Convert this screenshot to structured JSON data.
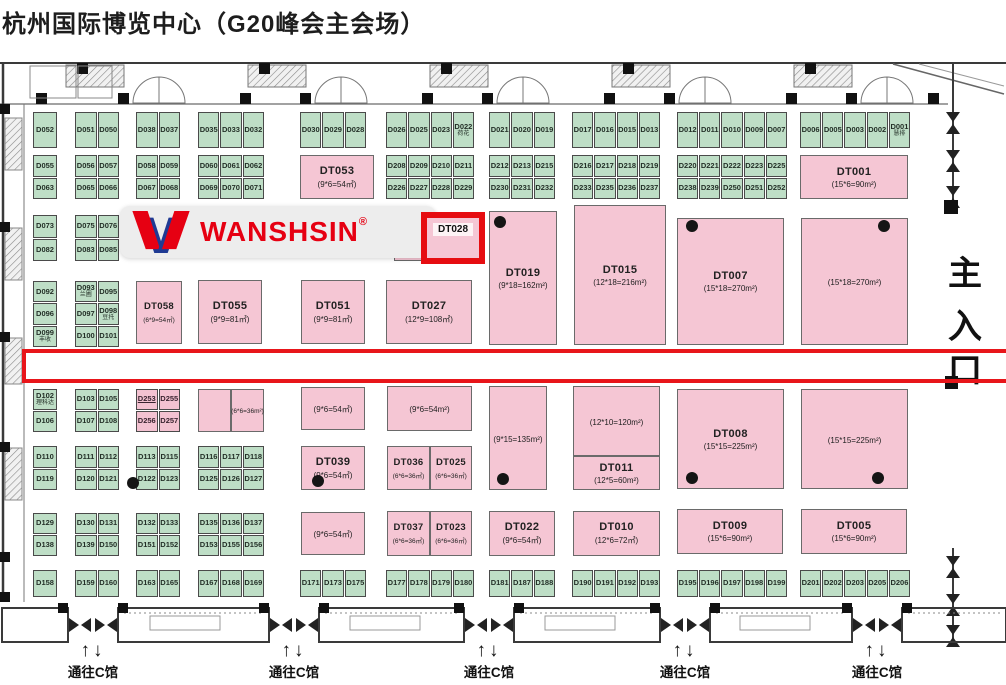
{
  "title": "杭州国际博览中心（G20峰会主会场）",
  "colors": {
    "green_booth": "#bedec6",
    "pink_booth": "#f5c6d4",
    "highlight_red": "#e8151a",
    "logo_red": "#e60012",
    "logo_blue": "#1f3a93"
  },
  "logo": {
    "text": "WANSHSIN",
    "reg": "®"
  },
  "entrance": {
    "chars": [
      "主",
      "入",
      "口"
    ]
  },
  "gates": {
    "label": "通往C馆",
    "arrows": "↑↓",
    "positions": [
      93,
      294,
      489,
      685,
      877
    ]
  },
  "annotations": {
    "highlight": {
      "label": "DT028",
      "x": 421,
      "y": 212,
      "w": 64,
      "h": 52
    },
    "aisle": {
      "x": 22,
      "y": 349,
      "w": 984,
      "h": 34
    },
    "banner": {
      "x": 120,
      "y": 206,
      "w": 292,
      "h": 52
    }
  },
  "floor": {
    "cell_groups": [
      {
        "x": 33,
        "y": 112,
        "w": 24,
        "h": 36,
        "rows": [
          [
            "D052"
          ]
        ]
      },
      {
        "x": 75,
        "y": 112,
        "w": 44,
        "h": 36,
        "rows": [
          [
            "D051",
            "D050"
          ]
        ]
      },
      {
        "x": 136,
        "y": 112,
        "w": 44,
        "h": 36,
        "rows": [
          [
            "D038",
            "D037"
          ]
        ]
      },
      {
        "x": 198,
        "y": 112,
        "w": 66,
        "h": 36,
        "rows": [
          [
            "D035",
            "D033",
            "D032"
          ]
        ]
      },
      {
        "x": 300,
        "y": 112,
        "w": 66,
        "h": 36,
        "rows": [
          [
            "D030",
            "D029",
            "D028"
          ]
        ]
      },
      {
        "x": 386,
        "y": 112,
        "w": 88,
        "h": 36,
        "rows": [
          [
            "D026",
            "D025",
            "D023",
            {
              "t": "D022",
              "sub": "荷花"
            }
          ]
        ]
      },
      {
        "x": 489,
        "y": 112,
        "w": 66,
        "h": 36,
        "rows": [
          [
            "D021",
            "D020",
            "D019"
          ]
        ]
      },
      {
        "x": 572,
        "y": 112,
        "w": 88,
        "h": 36,
        "rows": [
          [
            "D017",
            "D016",
            "D015",
            "D013"
          ]
        ]
      },
      {
        "x": 677,
        "y": 112,
        "w": 110,
        "h": 36,
        "rows": [
          [
            "D012",
            "D011",
            "D010",
            "D009",
            "D007"
          ]
        ]
      },
      {
        "x": 800,
        "y": 112,
        "w": 110,
        "h": 36,
        "rows": [
          [
            "D006",
            "D005",
            "D003",
            "D002",
            {
              "t": "D001",
              "sub": "慧排"
            }
          ]
        ]
      },
      {
        "x": 33,
        "y": 155,
        "w": 24,
        "h": 44,
        "rows": [
          [
            "D055"
          ],
          [
            "D063"
          ]
        ]
      },
      {
        "x": 75,
        "y": 155,
        "w": 44,
        "h": 44,
        "rows": [
          [
            "D056",
            "D057"
          ],
          [
            "D065",
            "D066"
          ]
        ]
      },
      {
        "x": 136,
        "y": 155,
        "w": 44,
        "h": 44,
        "rows": [
          [
            "D058",
            "D059"
          ],
          [
            "D067",
            "D068"
          ]
        ]
      },
      {
        "x": 198,
        "y": 155,
        "w": 66,
        "h": 44,
        "rows": [
          [
            "D060",
            "D061",
            "D062"
          ],
          [
            "D069",
            "D070",
            "D071"
          ]
        ]
      },
      {
        "x": 386,
        "y": 155,
        "w": 88,
        "h": 44,
        "rows": [
          [
            "D208",
            "D209",
            "D210",
            "D211"
          ],
          [
            "D226",
            "D227",
            "D228",
            "D229"
          ]
        ]
      },
      {
        "x": 489,
        "y": 155,
        "w": 66,
        "h": 44,
        "rows": [
          [
            "D212",
            "D213",
            "D215"
          ],
          [
            "D230",
            "D231",
            "D232"
          ]
        ]
      },
      {
        "x": 572,
        "y": 155,
        "w": 88,
        "h": 44,
        "rows": [
          [
            "D216",
            "D217",
            "D218",
            "D219"
          ],
          [
            "D233",
            "D235",
            "D236",
            "D237"
          ]
        ]
      },
      {
        "x": 677,
        "y": 155,
        "w": 110,
        "h": 44,
        "rows": [
          [
            "D220",
            "D221",
            "D222",
            "D223",
            "D225"
          ],
          [
            "D238",
            "D239",
            "D250",
            "D251",
            "D252"
          ]
        ]
      },
      {
        "x": 33,
        "y": 215,
        "w": 24,
        "h": 46,
        "rows": [
          [
            "D073"
          ],
          [
            "D082"
          ]
        ]
      },
      {
        "x": 75,
        "y": 215,
        "w": 44,
        "h": 46,
        "rows": [
          [
            "D075",
            "D076"
          ],
          [
            "D083",
            "D085"
          ]
        ]
      },
      {
        "x": 33,
        "y": 281,
        "w": 24,
        "h": 66,
        "rows": [
          [
            "D092"
          ],
          [
            "D096"
          ],
          [
            {
              "t": "D099",
              "sub": "丰收"
            }
          ]
        ]
      },
      {
        "x": 75,
        "y": 281,
        "w": 44,
        "h": 66,
        "rows": [
          [
            {
              "t": "D093",
              "sub": "兰圃"
            },
            "D095"
          ],
          [
            "D097",
            {
              "t": "D098",
              "sub": "豆托"
            }
          ],
          [
            "D100",
            "D101"
          ]
        ]
      },
      {
        "x": 33,
        "y": 389,
        "w": 24,
        "h": 43,
        "rows": [
          [
            {
              "t": "D102",
              "sub": "理科达"
            }
          ],
          [
            "D106"
          ]
        ]
      },
      {
        "x": 75,
        "y": 389,
        "w": 44,
        "h": 43,
        "rows": [
          [
            "D103",
            "D105"
          ],
          [
            "D107",
            "D108"
          ]
        ]
      },
      {
        "x": 136,
        "y": 389,
        "w": 44,
        "h": 43,
        "color": "pink",
        "rows": [
          [
            {
              "t": "D253",
              "u": true
            },
            "D255"
          ],
          [
            "D256",
            "D257"
          ]
        ]
      },
      {
        "x": 33,
        "y": 446,
        "w": 24,
        "h": 44,
        "rows": [
          [
            "D110"
          ],
          [
            "D119"
          ]
        ]
      },
      {
        "x": 75,
        "y": 446,
        "w": 44,
        "h": 44,
        "rows": [
          [
            "D111",
            "D112"
          ],
          [
            "D120",
            "D121"
          ]
        ]
      },
      {
        "x": 136,
        "y": 446,
        "w": 44,
        "h": 44,
        "rows": [
          [
            "D113",
            "D115"
          ],
          [
            "D122",
            "D123"
          ]
        ]
      },
      {
        "x": 198,
        "y": 446,
        "w": 66,
        "h": 44,
        "rows": [
          [
            "D116",
            "D117",
            "D118"
          ],
          [
            "D125",
            "D126",
            "D127"
          ]
        ]
      },
      {
        "x": 33,
        "y": 513,
        "w": 24,
        "h": 43,
        "rows": [
          [
            "D129"
          ],
          [
            "D138"
          ]
        ]
      },
      {
        "x": 75,
        "y": 513,
        "w": 44,
        "h": 43,
        "rows": [
          [
            "D130",
            "D131"
          ],
          [
            "D139",
            "D150"
          ]
        ]
      },
      {
        "x": 136,
        "y": 513,
        "w": 44,
        "h": 43,
        "rows": [
          [
            "D132",
            "D133"
          ],
          [
            "D151",
            "D152"
          ]
        ]
      },
      {
        "x": 198,
        "y": 513,
        "w": 66,
        "h": 43,
        "rows": [
          [
            "D135",
            "D136",
            "D137"
          ],
          [
            "D153",
            "D155",
            "D156"
          ]
        ]
      },
      {
        "x": 33,
        "y": 570,
        "w": 24,
        "h": 27,
        "rows": [
          [
            "D158"
          ]
        ]
      },
      {
        "x": 75,
        "y": 570,
        "w": 44,
        "h": 27,
        "rows": [
          [
            "D159",
            "D160"
          ]
        ]
      },
      {
        "x": 136,
        "y": 570,
        "w": 44,
        "h": 27,
        "rows": [
          [
            "D163",
            "D165"
          ]
        ]
      },
      {
        "x": 198,
        "y": 570,
        "w": 66,
        "h": 27,
        "rows": [
          [
            "D167",
            "D168",
            "D169"
          ]
        ]
      },
      {
        "x": 300,
        "y": 570,
        "w": 66,
        "h": 27,
        "rows": [
          [
            "D171",
            "D173",
            "D175"
          ]
        ]
      },
      {
        "x": 386,
        "y": 570,
        "w": 88,
        "h": 27,
        "rows": [
          [
            "D177",
            "D178",
            "D179",
            "D180"
          ]
        ]
      },
      {
        "x": 489,
        "y": 570,
        "w": 66,
        "h": 27,
        "rows": [
          [
            "D181",
            "D187",
            "D188"
          ]
        ]
      },
      {
        "x": 572,
        "y": 570,
        "w": 88,
        "h": 27,
        "rows": [
          [
            "D190",
            "D191",
            "D192",
            "D193"
          ]
        ]
      },
      {
        "x": 677,
        "y": 570,
        "w": 110,
        "h": 27,
        "rows": [
          [
            "D195",
            "D196",
            "D197",
            "D198",
            "D199"
          ]
        ]
      },
      {
        "x": 800,
        "y": 570,
        "w": 110,
        "h": 27,
        "rows": [
          [
            "D201",
            "D202",
            "D203",
            "D205",
            "D206"
          ]
        ]
      }
    ],
    "pink_booths": [
      {
        "name": "DT053",
        "size": "(9*6=54㎡)",
        "x": 300,
        "y": 155,
        "w": 74,
        "h": 44
      },
      {
        "name": "DT001",
        "size": "(15*6=90m²)",
        "x": 800,
        "y": 155,
        "w": 108,
        "h": 44
      },
      {
        "name": "",
        "size": "",
        "x": 394,
        "y": 213,
        "w": 30,
        "h": 48
      },
      {
        "name": "DT019",
        "size": "(9*18=162m²)",
        "x": 489,
        "y": 211,
        "w": 68,
        "h": 134
      },
      {
        "name": "DT015",
        "size": "(12*18=216m²)",
        "x": 574,
        "y": 205,
        "w": 92,
        "h": 140
      },
      {
        "name": "DT007",
        "size": "(15*18=270m²)",
        "x": 677,
        "y": 218,
        "w": 107,
        "h": 127
      },
      {
        "name": "",
        "size": "(15*18=270m²)",
        "x": 801,
        "y": 218,
        "w": 107,
        "h": 127
      },
      {
        "name": "DT058",
        "size": "(6*9=54㎡)",
        "x": 136,
        "y": 281,
        "w": 46,
        "h": 63
      },
      {
        "name": "DT055",
        "size": "(9*9=81㎡)",
        "x": 198,
        "y": 280,
        "w": 64,
        "h": 64
      },
      {
        "name": "DT051",
        "size": "(9*9=81㎡)",
        "x": 301,
        "y": 280,
        "w": 64,
        "h": 64
      },
      {
        "name": "DT027",
        "size": "(12*9=108㎡)",
        "x": 386,
        "y": 280,
        "w": 86,
        "h": 64
      },
      {
        "name": "",
        "size": "",
        "x": 198,
        "y": 389,
        "w": 33,
        "h": 43
      },
      {
        "name": "",
        "size": "(6*6=36m²)",
        "x": 231,
        "y": 389,
        "w": 33,
        "h": 43
      },
      {
        "name": "",
        "size": "(9*6=54㎡)",
        "x": 301,
        "y": 387,
        "w": 64,
        "h": 43
      },
      {
        "name": "",
        "size": "(9*6=54m²)",
        "x": 387,
        "y": 386,
        "w": 85,
        "h": 45
      },
      {
        "name": "",
        "size": "(9*15=135m²)",
        "x": 489,
        "y": 386,
        "w": 58,
        "h": 104
      },
      {
        "name": "",
        "size": "(12*10=120m²)",
        "x": 573,
        "y": 386,
        "w": 87,
        "h": 70
      },
      {
        "name": "DT011",
        "size": "(12*5=60m²)",
        "x": 573,
        "y": 456,
        "w": 87,
        "h": 34
      },
      {
        "name": "DT008",
        "size": "(15*15=225m²)",
        "x": 677,
        "y": 389,
        "w": 107,
        "h": 100
      },
      {
        "name": "",
        "size": "(15*15=225m²)",
        "x": 801,
        "y": 389,
        "w": 107,
        "h": 100
      },
      {
        "name": "DT039",
        "size": "(9*6=54㎡)",
        "x": 301,
        "y": 446,
        "w": 64,
        "h": 44
      },
      {
        "name": "DT036",
        "size": "(6*6=36㎡)",
        "x": 387,
        "y": 446,
        "w": 43,
        "h": 44
      },
      {
        "name": "DT025",
        "size": "(6*6=36㎡)",
        "x": 430,
        "y": 446,
        "w": 42,
        "h": 44
      },
      {
        "name": "",
        "size": "(9*6=54㎡)",
        "x": 301,
        "y": 512,
        "w": 64,
        "h": 43
      },
      {
        "name": "DT037",
        "size": "(6*6=36㎡)",
        "x": 387,
        "y": 511,
        "w": 43,
        "h": 45
      },
      {
        "name": "DT023",
        "size": "(6*6=36㎡)",
        "x": 430,
        "y": 511,
        "w": 42,
        "h": 45
      },
      {
        "name": "DT022",
        "size": "(9*6=54㎡)",
        "x": 489,
        "y": 511,
        "w": 66,
        "h": 45
      },
      {
        "name": "DT010",
        "size": "(12*6=72㎡)",
        "x": 573,
        "y": 511,
        "w": 87,
        "h": 45
      },
      {
        "name": "DT009",
        "size": "(15*6=90m²)",
        "x": 677,
        "y": 509,
        "w": 106,
        "h": 45
      },
      {
        "name": "DT005",
        "size": "(15*6=90m²)",
        "x": 801,
        "y": 509,
        "w": 106,
        "h": 45
      }
    ],
    "dots": [
      {
        "x": 500,
        "y": 222
      },
      {
        "x": 692,
        "y": 226
      },
      {
        "x": 884,
        "y": 226
      },
      {
        "x": 133,
        "y": 483
      },
      {
        "x": 318,
        "y": 481
      },
      {
        "x": 503,
        "y": 479
      },
      {
        "x": 692,
        "y": 478
      },
      {
        "x": 878,
        "y": 478
      }
    ]
  }
}
